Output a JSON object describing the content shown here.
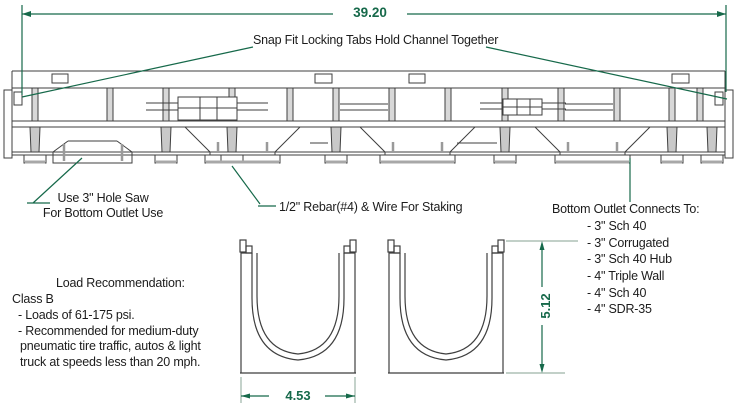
{
  "diagram": {
    "dimensions": {
      "overall_length": "39.20",
      "width": "4.53",
      "height": "5.12"
    },
    "annotations": {
      "snap_fit": "Snap Fit Locking Tabs Hold Channel Together",
      "hole_saw_line1": "Use 3\" Hole Saw",
      "hole_saw_line2": "For Bottom Outlet Use",
      "rebar": "1/2\" Rebar(#4) & Wire For Staking",
      "bottom_outlet": {
        "title": "Bottom Outlet Connects To:",
        "items": [
          "- 3\" Sch 40",
          "- 3\" Corrugated",
          "- 3\" Sch 40 Hub",
          "- 4\" Triple Wall",
          "- 4\" Sch 40",
          "- 4\" SDR-35"
        ]
      }
    },
    "load_recommendation": {
      "title": "Load Recommendation:",
      "class_label": "Class B",
      "lines": [
        "- Loads of 61-175 psi.",
        "- Recommended for medium-duty",
        "pneumatic tire traffic, autos & light",
        "truck at speeds less than 20 mph."
      ]
    },
    "colors": {
      "dimension_green": "#16694a",
      "extension_pale_green": "#9db4a8",
      "line_art_gray": "#3f3f3f"
    }
  }
}
